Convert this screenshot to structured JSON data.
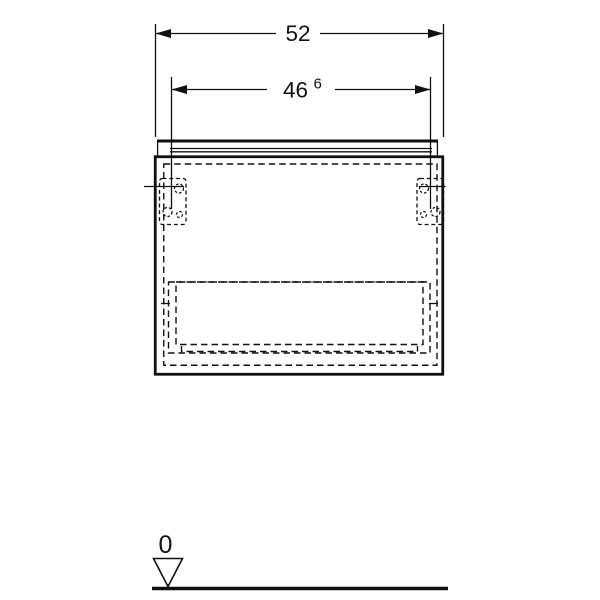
{
  "colors": {
    "line": "#111111",
    "background": "#ffffff"
  },
  "dimensions": {
    "overall": {
      "value": "52"
    },
    "inner": {
      "value": "46",
      "sup": "6"
    },
    "datum": {
      "value": "0",
      "symbol": "inverted-triangle"
    }
  }
}
